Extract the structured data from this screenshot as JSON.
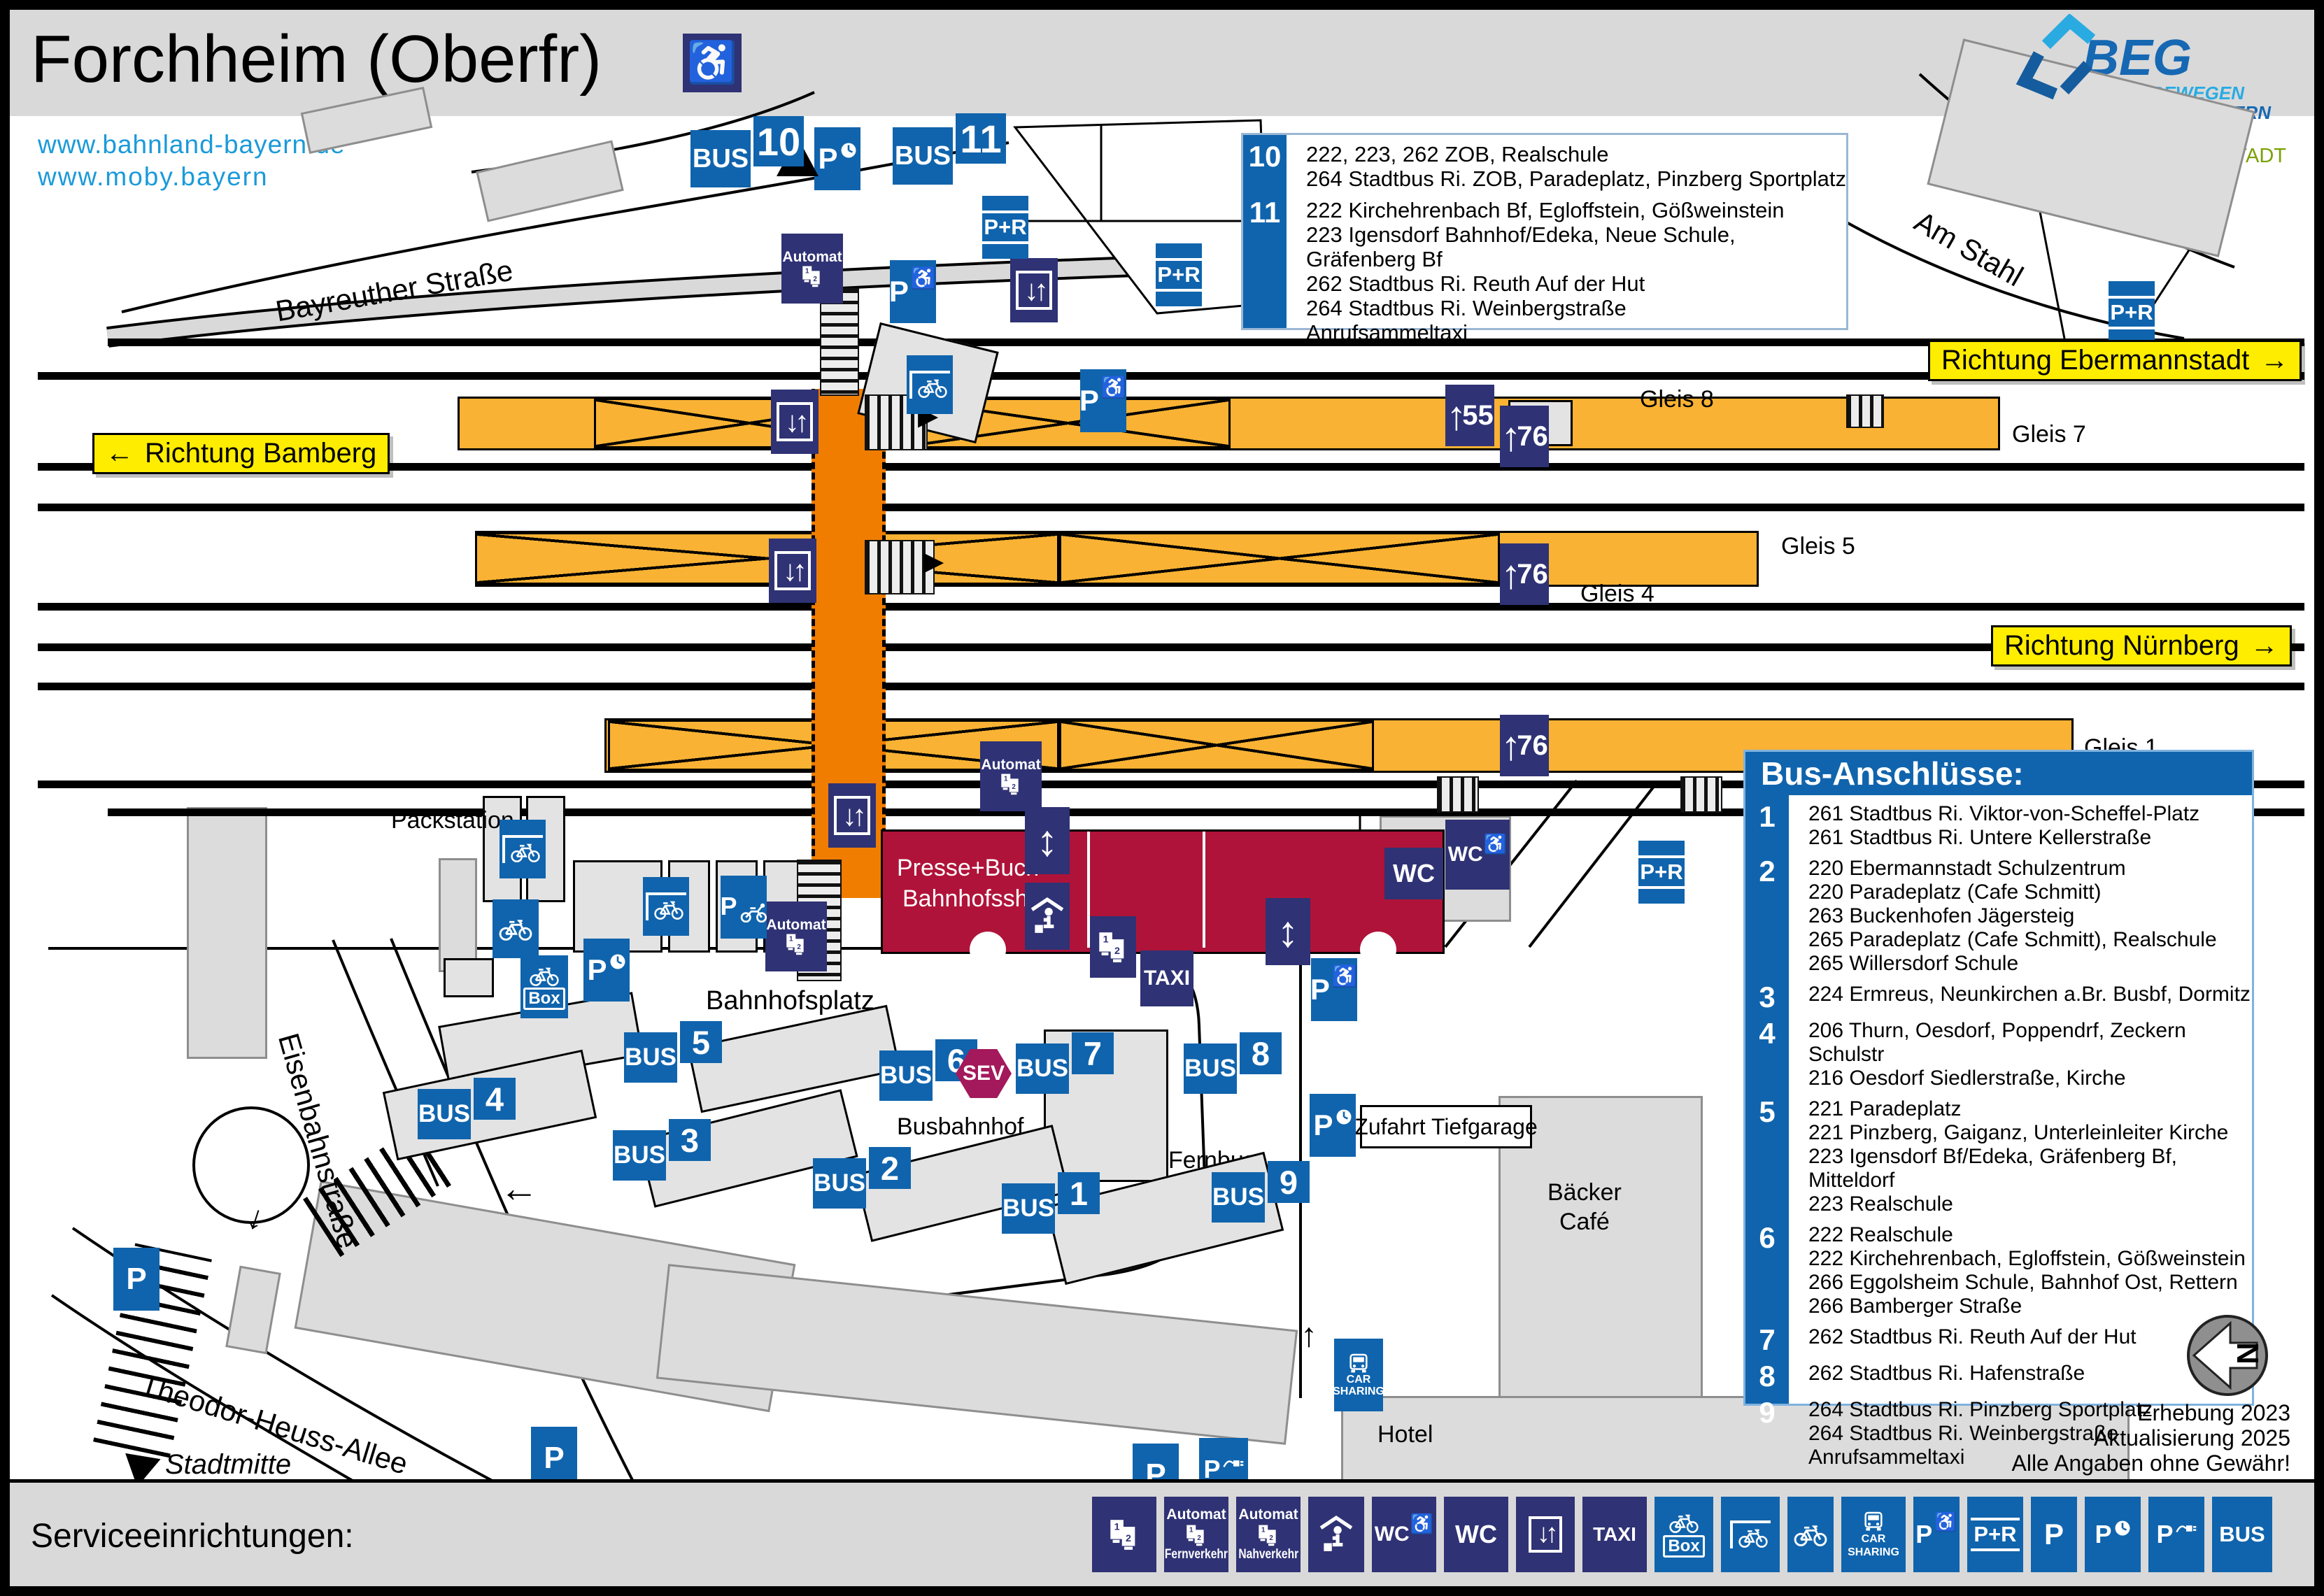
{
  "header": {
    "title": "Forchheim (Oberfr)",
    "links": [
      "www.bahnland-bayern.de",
      "www.moby.bayern"
    ],
    "beg": {
      "name": "BEG",
      "tagline1": "WIR BEWEGEN",
      "tagline2": "DAS BAHNLAND BAYERN"
    },
    "credit": {
      "symbol": "©",
      "part1": "Bahn",
      "part2": "Stadt"
    }
  },
  "top_routes": {
    "groups": [
      {
        "stop": "10",
        "lines": [
          "222, 223, 262 ZOB, Realschule",
          "264 Stadtbus Ri. ZOB, Paradeplatz, Pinzberg Sportplatz"
        ]
      },
      {
        "stop": "11",
        "lines": [
          "222 Kirchehrenbach Bf, Egloffstein, Gößweinstein",
          "223 Igensdorf Bahnhof/Edeka, Neue Schule, Gräfenberg Bf",
          "262 Stadtbus Ri. Reuth Auf der Hut",
          "264 Stadtbus Ri. Weinbergstraße",
          "Anrufsammeltaxi"
        ]
      }
    ]
  },
  "bus_connections": {
    "title": "Bus-Anschlüsse:",
    "groups": [
      {
        "stop": "1",
        "lines": [
          "261 Stadtbus Ri. Viktor-von-Scheffel-Platz",
          "261 Stadtbus Ri. Untere Kellerstraße"
        ]
      },
      {
        "stop": "2",
        "lines": [
          "220 Ebermannstadt Schulzentrum",
          "220 Paradeplatz (Cafe Schmitt)",
          "263 Buckenhofen Jägersteig",
          "265 Paradeplatz (Cafe Schmitt), Realschule",
          "265 Willersdorf Schule"
        ]
      },
      {
        "stop": "3",
        "lines": [
          "224 Ermreus, Neunkirchen a.Br. Busbf, Dormitz"
        ]
      },
      {
        "stop": "4",
        "lines": [
          "206 Thurn, Oesdorf, Poppendrf, Zeckern Schulstr",
          "216 Oesdorf Siedlerstraße, Kirche"
        ]
      },
      {
        "stop": "5",
        "lines": [
          "221 Paradeplatz",
          "221 Pinzberg, Gaiganz, Unterleinleiter Kirche",
          "223 Igensdorf Bf/Edeka, Gräfenberg Bf, Mitteldorf",
          "223 Realschule"
        ]
      },
      {
        "stop": "6",
        "lines": [
          "222 Realschule",
          "222 Kirchehrenbach, Egloffstein, Gößweinstein",
          "266 Eggolsheim Schule, Bahnhof Ost, Rettern",
          "266 Bamberger Straße"
        ]
      },
      {
        "stop": "7",
        "lines": [
          "262 Stadtbus Ri. Reuth Auf der Hut"
        ]
      },
      {
        "stop": "8",
        "lines": [
          "262 Stadtbus Ri. Hafenstraße"
        ]
      },
      {
        "stop": "9",
        "lines": [
          "264 Stadtbus Ri. Pinzberg Sportplatz",
          "264 Stadtbus Ri. Weinbergstraße",
          "Anrufsammeltaxi"
        ]
      }
    ]
  },
  "map": {
    "directions": {
      "bamberg": "Richtung Bamberg",
      "ebermannstadt": "Richtung Ebermannstadt",
      "nuernberg": "Richtung Nürnberg",
      "arrow_left": "←",
      "arrow_right": "→",
      "arrow_up": "↑",
      "arrow_down": "↓"
    },
    "streets": {
      "bayreuther": "Bayreuther Straße",
      "am_stahl": "Am Stahl",
      "eisenbahn": "Eisenbahnstraße",
      "theodor": "Theodor-Heuss-Allee",
      "stadtmitte": "Stadtmitte"
    },
    "labels": {
      "bahnhofsplatz": "Bahnhofsplatz",
      "busbahnhof": "Busbahnhof",
      "fernbus1": "Fernbus-",
      "fernbus2": "abfahrten",
      "packstation": "Packstation",
      "zufahrt": "Zufahrt Tiefgarage",
      "baecker1": "Bäcker",
      "baecker2": "Café",
      "hotel": "Hotel",
      "shop1": "Presse+Buch",
      "shop2": "Bahnhofsshop"
    },
    "gleise": {
      "g8": "Gleis 8",
      "g7": "Gleis 7",
      "g5": "Gleis 5",
      "g4": "Gleis 4",
      "g1": "Gleis 1"
    },
    "platform_heights": {
      "h55": "55",
      "h76": "76"
    },
    "bus_stops": [
      "1",
      "2",
      "3",
      "4",
      "5",
      "6",
      "7",
      "8",
      "9"
    ],
    "top_stops": [
      "10",
      "11"
    ],
    "signs": {
      "bus": "BUS",
      "taxi": "TAXI",
      "wc": "WC",
      "p": "P",
      "pr": "P+R",
      "sev": "SEV",
      "box": "Box",
      "car": "CAR",
      "sharing": "SHARING",
      "automat": "Automat",
      "elevator": "↓↑",
      "updown": "↕",
      "wheelchair": "♿",
      "north": "N"
    }
  },
  "footer": {
    "label": "Serviceeinrichtungen:",
    "automat": "Automat",
    "fernverkehr": "Fernverkehr",
    "nahverkehr": "Nahverkehr"
  },
  "notes": [
    "Erhebung 2023",
    "Aktualisierung 2025",
    "Alle Angaben ohne Gewähr!"
  ],
  "colors": {
    "sign_blue": "#1064ad",
    "sign_navy": "#2f3274",
    "platform_orange": "#f9b233",
    "underpass_orange": "#f07d00",
    "station_red": "#b01339",
    "highlight_yellow": "#ffed00",
    "sev_magenta": "#a3195b",
    "link_blue": "#1a9ad9",
    "beg_blue": "#1668b3",
    "beg_light": "#29abe2",
    "credit_green": "#7ba005"
  }
}
